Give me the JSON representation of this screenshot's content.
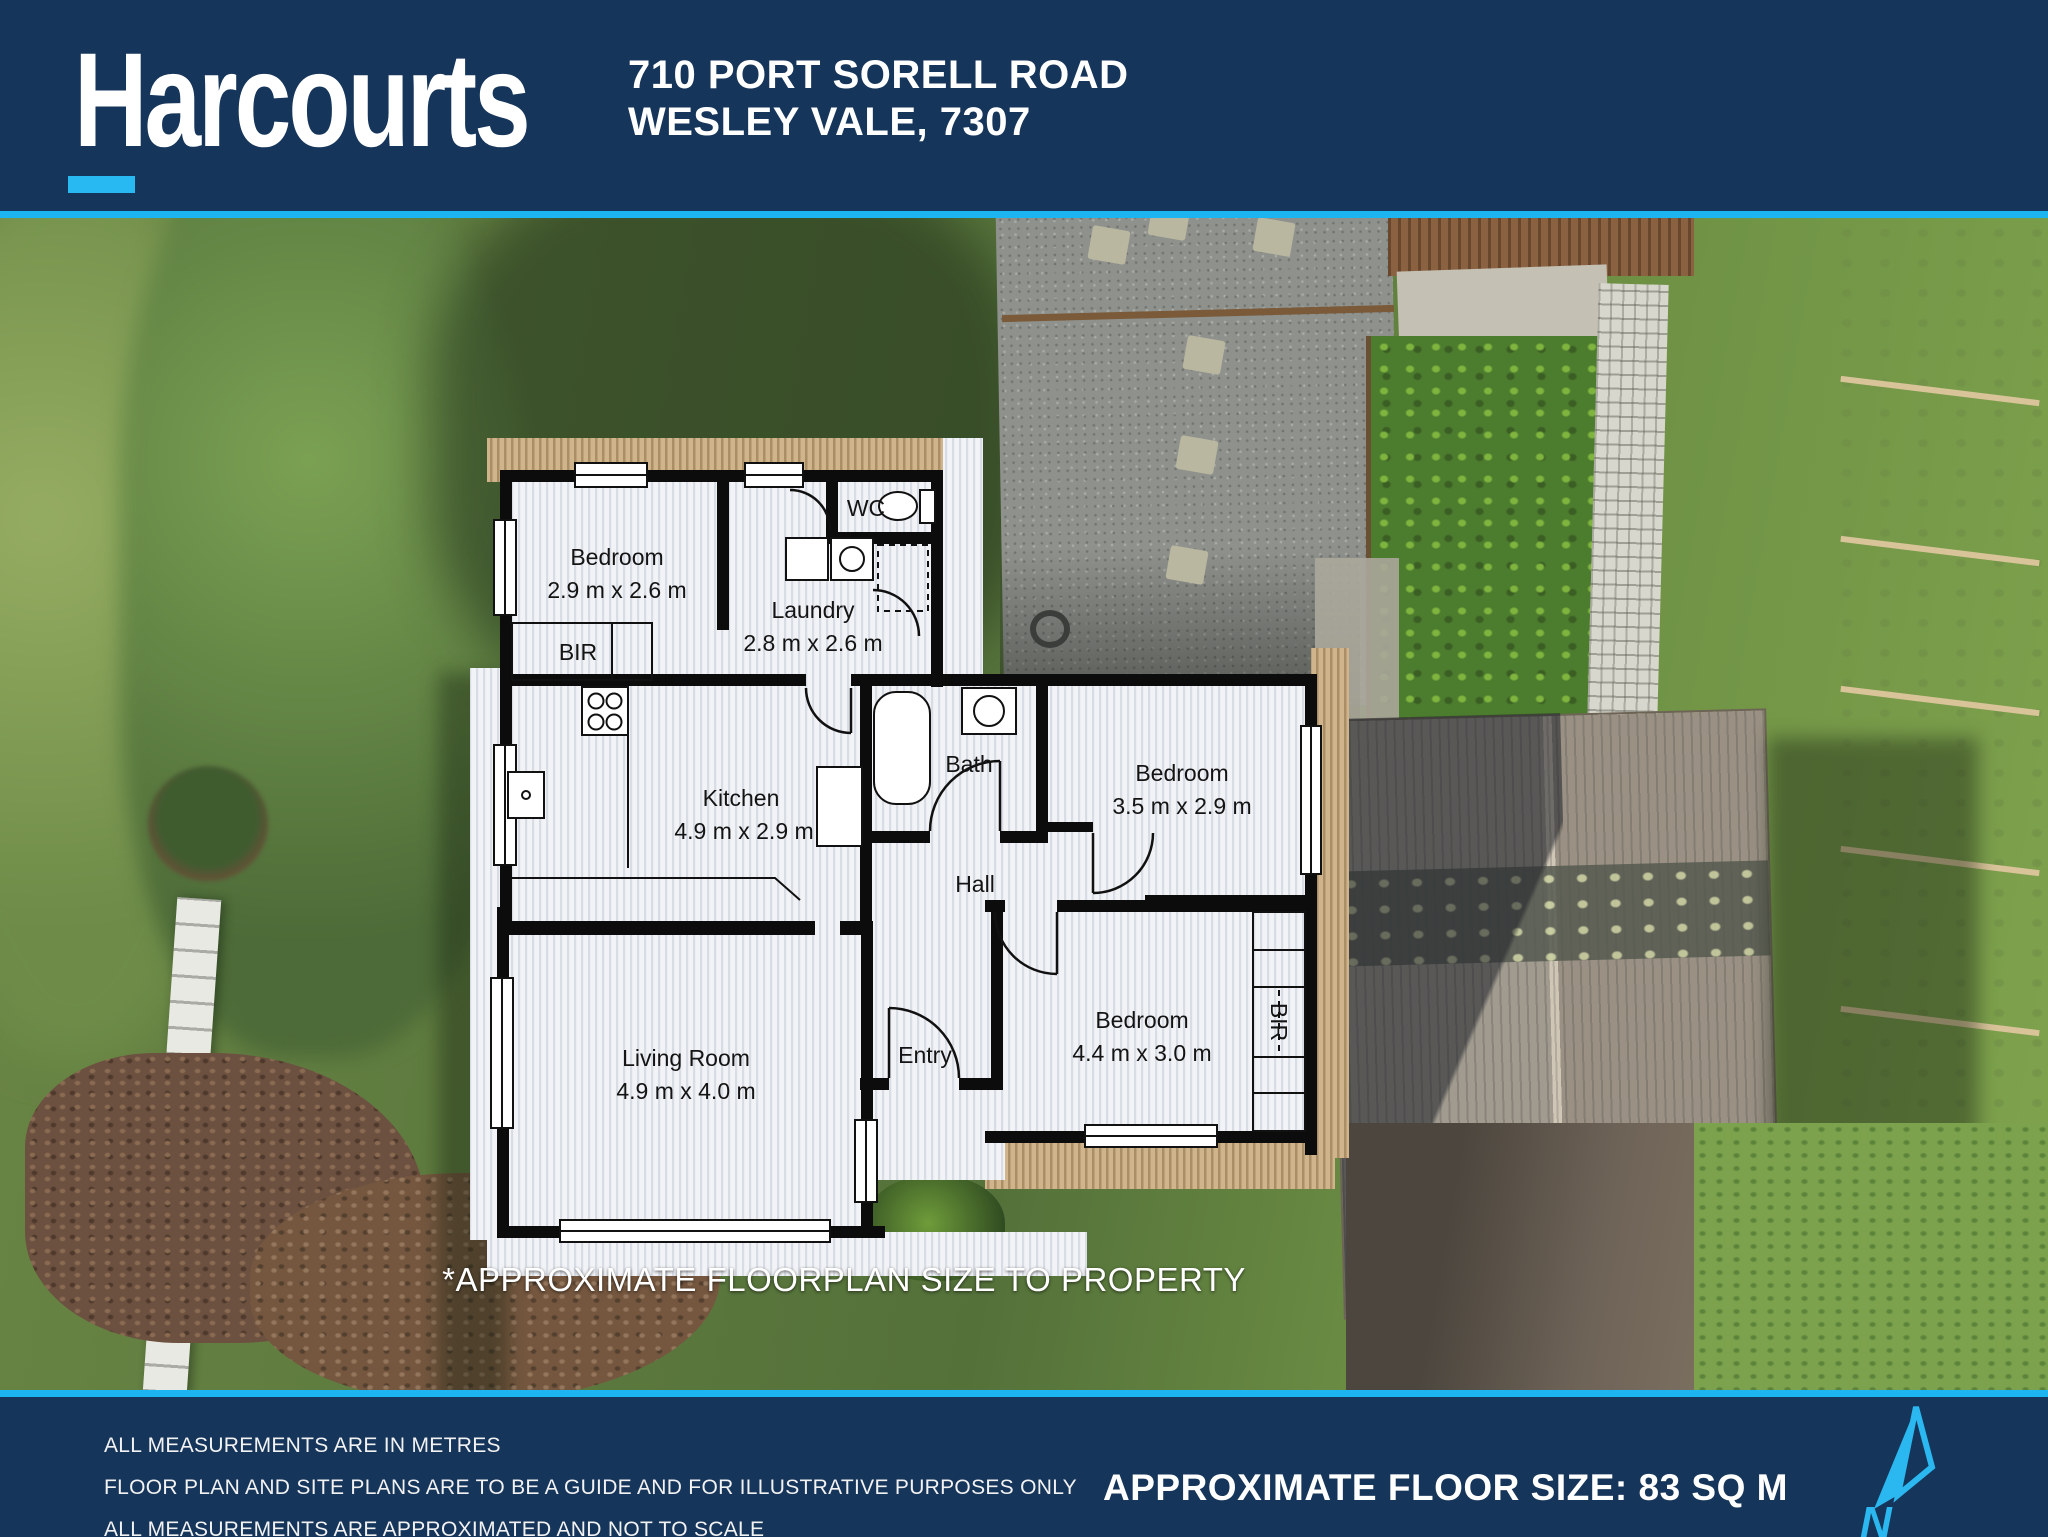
{
  "header": {
    "brand": "Harcourts",
    "address_line1": "710 PORT SORELL ROAD",
    "address_line2": "WESLEY VALE, 7307"
  },
  "colors": {
    "brand_navy": "#16355a",
    "accent_cyan": "#1db4f2"
  },
  "floorplan": {
    "caption": "*APPROXIMATE FLOORPLAN SIZE TO PROPERTY",
    "rooms": {
      "bedroom1": {
        "name": "Bedroom",
        "dims": "2.9 m x 2.6 m"
      },
      "laundry": {
        "name": "Laundry",
        "dims": "2.8 m x 2.6 m"
      },
      "wc": {
        "name": "WC"
      },
      "bir1": {
        "name": "BIR"
      },
      "kitchen": {
        "name": "Kitchen",
        "dims": "4.9 m x 2.9 m"
      },
      "bath": {
        "name": "Bath"
      },
      "hall": {
        "name": "Hall"
      },
      "bedroom2": {
        "name": "Bedroom",
        "dims": "3.5 m x 2.9 m"
      },
      "living": {
        "name": "Living Room",
        "dims": "4.9 m x 4.0 m"
      },
      "entry": {
        "name": "Entry"
      },
      "bedroom3": {
        "name": "Bedroom",
        "dims": "4.4 m x 3.0 m"
      },
      "bir2": {
        "name": "BIR"
      }
    }
  },
  "footer": {
    "disclaimer1": "ALL MEASUREMENTS ARE IN METRES",
    "disclaimer2": "FLOOR PLAN AND SITE PLANS ARE TO BE A GUIDE AND FOR ILLUSTRATIVE PURPOSES ONLY",
    "disclaimer3": "ALL MEASUREMENTS ARE APPROXIMATED AND NOT TO SCALE",
    "floor_size": "APPROXIMATE FLOOR SIZE: 83 SQ M",
    "north_label": "N"
  }
}
